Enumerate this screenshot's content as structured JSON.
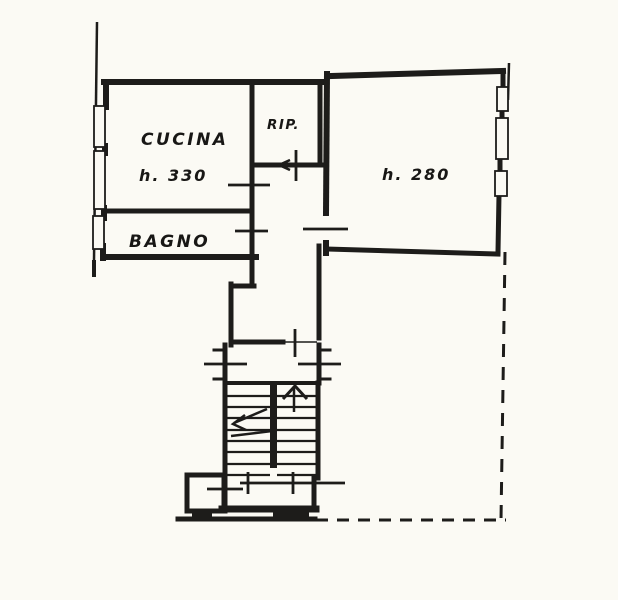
{
  "colors": {
    "ink": "#1d1c1a",
    "paper": "#fbfaf4"
  },
  "labels": {
    "cucina": "CUCINA",
    "cucina_height": "h. 330",
    "bagno": "BAGNO",
    "rip": "RIP.",
    "main_height": "h. 280"
  }
}
